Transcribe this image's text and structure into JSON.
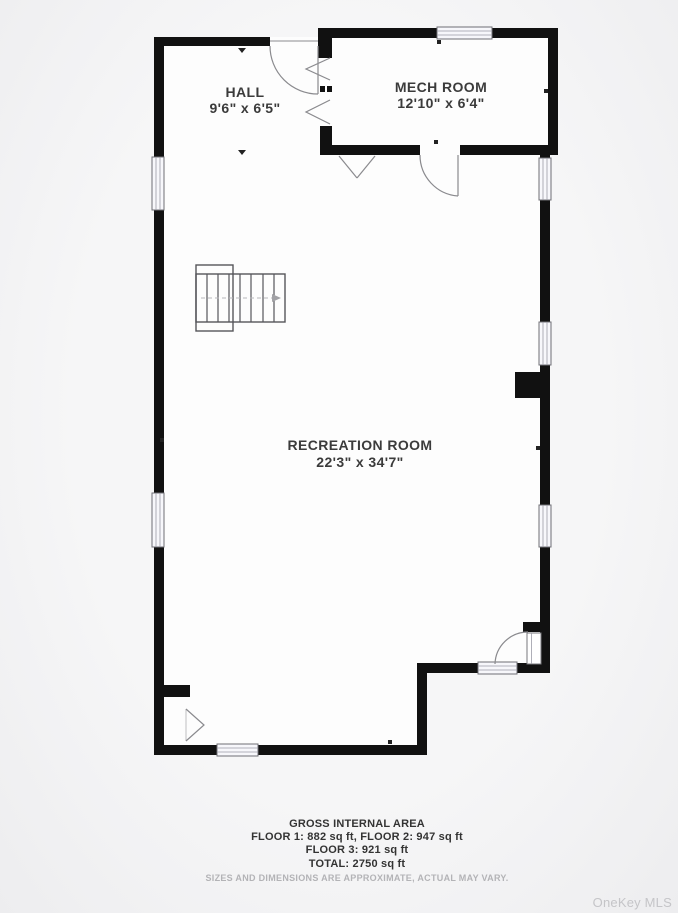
{
  "rooms": {
    "hall": {
      "name": "HALL",
      "dims": "9'6\" x 6'5\""
    },
    "mech": {
      "name": "MECH ROOM",
      "dims": "12'10\" x 6'4\""
    },
    "recreation": {
      "name": "RECREATION ROOM",
      "dims": "22'3\" x 34'7\""
    }
  },
  "footer": {
    "title": "GROSS INTERNAL AREA",
    "line1": "FLOOR 1: 882 sq ft, FLOOR 2: 947 sq ft",
    "line2": "FLOOR 3: 921 sq ft",
    "line3": "TOTAL: 2750 sq ft",
    "disclaimer": "SIZES AND DIMENSIONS ARE APPROXIMATE, ACTUAL MAY VARY."
  },
  "watermark": "OneKey MLS",
  "colors": {
    "wall": "#111111",
    "background": "#f2f2f3",
    "room_fill": "#fdfdfd",
    "text": "#3b3b3b",
    "muted": "#b3b3b6",
    "watermark": "#c5c5c8"
  }
}
